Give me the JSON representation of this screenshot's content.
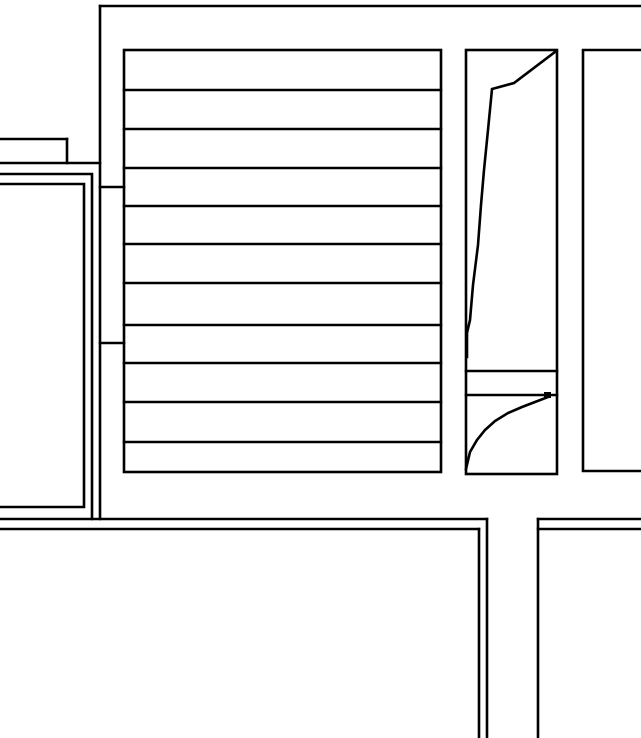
{
  "canvas": {
    "width": 641,
    "height": 738,
    "background_color": "#ffffff",
    "line_color": "#000000",
    "line_width": 2.6
  },
  "drawing": {
    "kind": "floor-plan-line-drawing",
    "shapes": [
      {
        "name": "top-boundary-wall",
        "type": "line",
        "x1": 100,
        "y1": 6,
        "x2": 641,
        "y2": 6
      },
      {
        "name": "stairwell-west-wall",
        "type": "line",
        "x1": 100,
        "y1": 6,
        "x2": 100,
        "y2": 519
      },
      {
        "name": "west-corridor-wall-upper",
        "type": "line",
        "x1": 0,
        "y1": 139,
        "x2": 67,
        "y2": 139
      },
      {
        "name": "west-corridor-wall-endcap",
        "type": "line",
        "x1": 67,
        "y1": 139,
        "x2": 67,
        "y2": 163
      },
      {
        "name": "west-corridor-wall-lower",
        "type": "line",
        "x1": 0,
        "y1": 163,
        "x2": 100,
        "y2": 163
      },
      {
        "name": "stairwell-wall-tie-upper",
        "type": "line",
        "x1": 100,
        "y1": 187,
        "x2": 124,
        "y2": 187
      },
      {
        "name": "stairwell-wall-tie-lower",
        "type": "line",
        "x1": 100,
        "y1": 343,
        "x2": 124,
        "y2": 343
      },
      {
        "name": "left-room-wall-outer",
        "type": "polyline",
        "points": [
          [
            0,
            174
          ],
          [
            92,
            174
          ],
          [
            92,
            519
          ]
        ]
      },
      {
        "name": "left-room-wall-inner",
        "type": "polyline",
        "points": [
          [
            0,
            184
          ],
          [
            84,
            184
          ],
          [
            84,
            507
          ],
          [
            0,
            507
          ]
        ]
      },
      {
        "name": "south-wall-outer-left",
        "type": "line",
        "x1": 0,
        "y1": 519,
        "x2": 487,
        "y2": 519
      },
      {
        "name": "south-wall-inner-left",
        "type": "line",
        "x1": 0,
        "y1": 529,
        "x2": 479,
        "y2": 529
      },
      {
        "name": "corridor-west-wall-outer",
        "type": "line",
        "x1": 487,
        "y1": 519,
        "x2": 487,
        "y2": 738
      },
      {
        "name": "corridor-west-wall-inner",
        "type": "line",
        "x1": 479,
        "y1": 529,
        "x2": 479,
        "y2": 738
      },
      {
        "name": "corridor-east-wall",
        "type": "line",
        "x1": 538,
        "y1": 519,
        "x2": 538,
        "y2": 738
      },
      {
        "name": "south-wall-outer-right",
        "type": "line",
        "x1": 538,
        "y1": 519,
        "x2": 641,
        "y2": 519
      },
      {
        "name": "south-wall-inner-right",
        "type": "line",
        "x1": 538,
        "y1": 529,
        "x2": 641,
        "y2": 529
      },
      {
        "name": "stair-outline",
        "type": "rect",
        "x": 124,
        "y": 50,
        "w": 317,
        "h": 422
      },
      {
        "name": "stair-tread-1",
        "type": "line",
        "x1": 124,
        "y1": 90,
        "x2": 441,
        "y2": 90
      },
      {
        "name": "stair-tread-2",
        "type": "line",
        "x1": 124,
        "y1": 129,
        "x2": 441,
        "y2": 129
      },
      {
        "name": "stair-tread-3",
        "type": "line",
        "x1": 124,
        "y1": 168,
        "x2": 441,
        "y2": 168
      },
      {
        "name": "stair-tread-4",
        "type": "line",
        "x1": 124,
        "y1": 206,
        "x2": 441,
        "y2": 206
      },
      {
        "name": "stair-tread-5",
        "type": "line",
        "x1": 124,
        "y1": 244,
        "x2": 441,
        "y2": 244
      },
      {
        "name": "stair-tread-6",
        "type": "line",
        "x1": 124,
        "y1": 283,
        "x2": 441,
        "y2": 283
      },
      {
        "name": "stair-tread-7",
        "type": "line",
        "x1": 124,
        "y1": 325,
        "x2": 441,
        "y2": 325
      },
      {
        "name": "stair-tread-8",
        "type": "line",
        "x1": 124,
        "y1": 363,
        "x2": 441,
        "y2": 363
      },
      {
        "name": "stair-tread-9",
        "type": "line",
        "x1": 124,
        "y1": 402,
        "x2": 441,
        "y2": 402
      },
      {
        "name": "stair-tread-10",
        "type": "line",
        "x1": 124,
        "y1": 442,
        "x2": 441,
        "y2": 442
      },
      {
        "name": "shaft-outline",
        "type": "rect",
        "x": 466,
        "y": 50,
        "w": 91,
        "h": 424
      },
      {
        "name": "shaft-divider-upper",
        "type": "line",
        "x1": 466,
        "y1": 371,
        "x2": 557,
        "y2": 371
      },
      {
        "name": "shaft-divider-lower",
        "type": "line",
        "x1": 466,
        "y1": 395,
        "x2": 557,
        "y2": 395
      },
      {
        "name": "door-leaf-upper",
        "type": "polyline",
        "points": [
          [
            555,
            52
          ],
          [
            514,
            83
          ],
          [
            492,
            89
          ],
          [
            488,
            130
          ],
          [
            484,
            170
          ],
          [
            481,
            205
          ],
          [
            478,
            245
          ],
          [
            473,
            285
          ],
          [
            470,
            320
          ],
          [
            467,
            333
          ],
          [
            467,
            357
          ]
        ]
      },
      {
        "name": "door-swing-lower",
        "type": "polyline",
        "points": [
          [
            466,
            469
          ],
          [
            470,
            452
          ],
          [
            477,
            440
          ],
          [
            485,
            430
          ],
          [
            495,
            421
          ],
          [
            508,
            413
          ],
          [
            522,
            407
          ],
          [
            535,
            402
          ],
          [
            548,
            397
          ]
        ]
      },
      {
        "name": "door-swing-endpoint",
        "type": "dot",
        "x": 544,
        "y": 392,
        "w": 7,
        "h": 6
      },
      {
        "name": "right-room-wall",
        "type": "polyline",
        "points": [
          [
            641,
            50
          ],
          [
            583,
            50
          ],
          [
            583,
            471
          ],
          [
            641,
            471
          ]
        ]
      }
    ]
  }
}
